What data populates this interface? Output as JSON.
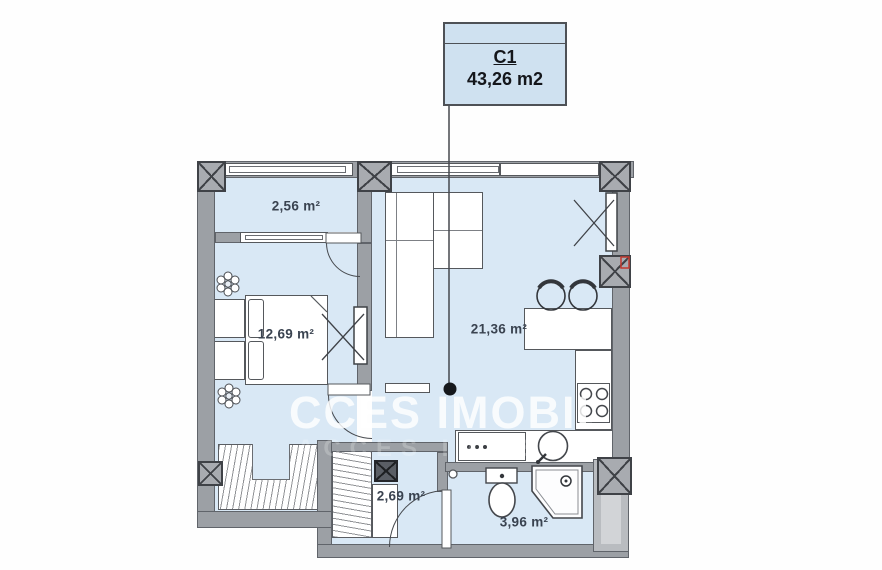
{
  "title_box": {
    "unit": "C1",
    "area": "43,26 m2"
  },
  "rooms": {
    "balcony": {
      "label": "2,56 m²"
    },
    "bedroom": {
      "label": "12,69 m²"
    },
    "living_kitchen": {
      "label": "21,36 m²"
    },
    "hallway": {
      "label": "2,69 m²"
    },
    "bathroom": {
      "label": "3,96 m²"
    }
  },
  "watermark": {
    "brand": "ACCES IMOBIL",
    "text_after_logo": "CCES IMOBIL"
  },
  "colors": {
    "room_fill": "#d9e8f5",
    "wall_gray": "#9ca0a5",
    "line_dark": "#55585c",
    "title_fill": "#cfe1f0",
    "label_text": "#3a4350",
    "accent_red": "#c3392f",
    "watermark_white": "#ffffff"
  }
}
